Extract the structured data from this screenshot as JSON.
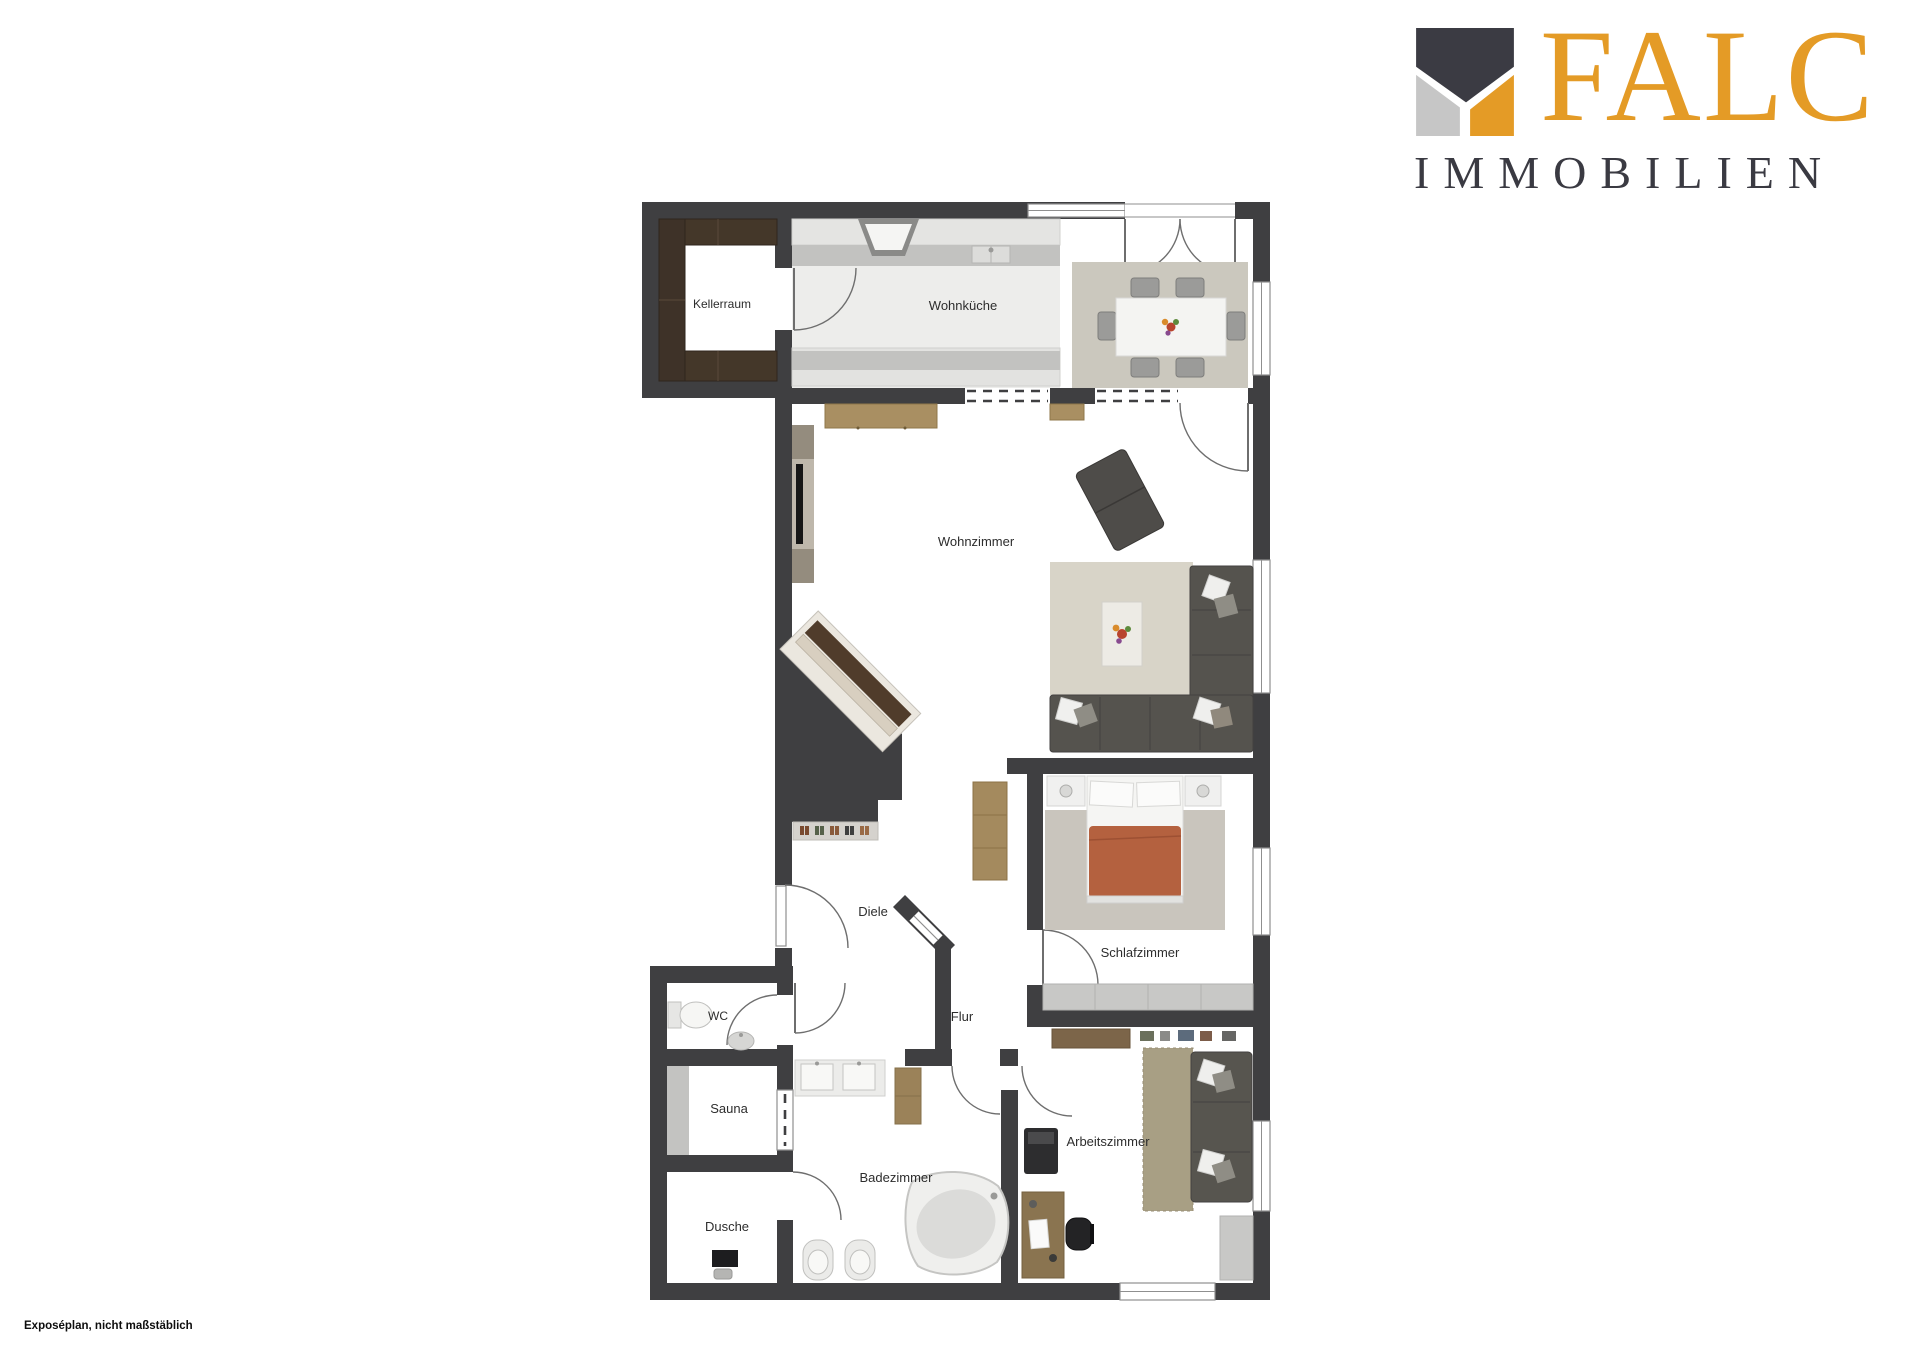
{
  "logo": {
    "brand": "FALC",
    "subtitle": "IMMOBILIEN",
    "colors": {
      "orange": "#E49B26",
      "dark": "#3A3A42",
      "gray": "#C6C6C6"
    }
  },
  "footer": {
    "note": "Exposéplan, nicht maßstäblich"
  },
  "floorplan": {
    "wall_color": "#3F3F41",
    "rooms": [
      {
        "id": "kellerraum",
        "label": "Kellerraum"
      },
      {
        "id": "wohnkueche",
        "label": "Wohnküche"
      },
      {
        "id": "wohnzimmer",
        "label": "Wohnzimmer"
      },
      {
        "id": "diele",
        "label": "Diele"
      },
      {
        "id": "wc",
        "label": "WC"
      },
      {
        "id": "flur",
        "label": "Flur"
      },
      {
        "id": "schlafzimmer",
        "label": "Schlafzimmer"
      },
      {
        "id": "sauna",
        "label": "Sauna"
      },
      {
        "id": "dusche",
        "label": "Dusche"
      },
      {
        "id": "badezimmer",
        "label": "Badezimmer"
      },
      {
        "id": "arbeitszimmer",
        "label": "Arbeitszimmer"
      }
    ]
  }
}
